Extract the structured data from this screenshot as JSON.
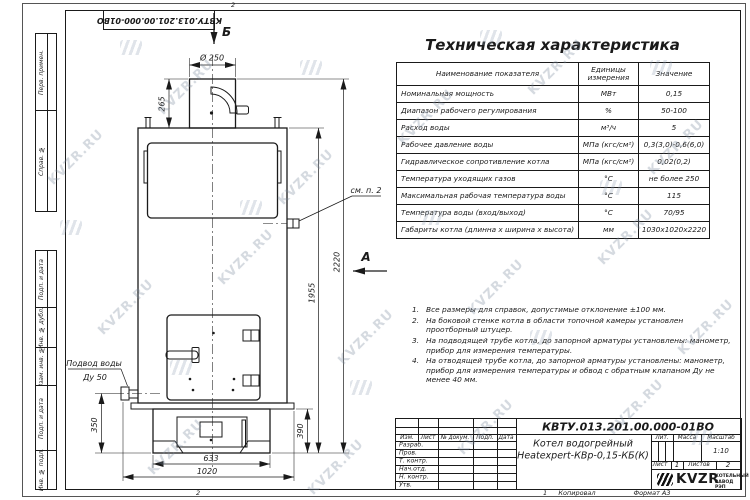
{
  "watermark": {
    "text": "KVZR.RU"
  },
  "margin": {
    "doc_number_rotated": "КВТУ.013.201.00.000-01ВО",
    "zone_top": "2",
    "zone_bottom_a": "2",
    "zone_bottom_b": "1",
    "copied_label": "Копировал",
    "format_label": "Формат А3",
    "side_boxes": [
      {
        "label": "Перв. примен."
      },
      {
        "label": "Справ. №"
      },
      {
        "label": "Подп. и дата"
      },
      {
        "label": "Инв. № дубл."
      },
      {
        "label": "Взам. инв. №"
      },
      {
        "label": "Подп. и дата"
      },
      {
        "label": "Инв. № подл."
      }
    ]
  },
  "spec_table": {
    "title": "Техническая характеристика",
    "headers": [
      "Наименование показателя",
      "Единицы измерения",
      "Значение"
    ],
    "rows": [
      {
        "name": "Номинальная мощность",
        "unit": "МВт",
        "value": "0,15"
      },
      {
        "name": "Диапазон рабочего регулирования",
        "unit": "%",
        "value": "50-100"
      },
      {
        "name": "Расход воды",
        "unit": "м³/ч",
        "value": "5"
      },
      {
        "name": "Рабочее давление воды",
        "unit": "МПа (кгс/см²)",
        "value": "0,3(3,0)-0,6(6,0)"
      },
      {
        "name": "Гидравлическое сопротивление котла",
        "unit": "МПа (кгс/см²)",
        "value": "0,02(0,2)"
      },
      {
        "name": "Температура уходящих газов",
        "unit": "°С",
        "value": "не более 250"
      },
      {
        "name": "Максимальная рабочая температура воды",
        "unit": "°С",
        "value": "115"
      },
      {
        "name": "Температура воды (вход/выход)",
        "unit": "°С",
        "value": "70/95"
      },
      {
        "name": "Габариты котла (длинна х ширина х высота)",
        "unit": "мм",
        "value": "1030х1020х2220"
      }
    ]
  },
  "notes": {
    "items": [
      {
        "num": "1.",
        "text": "Все размеры для справок, допустимые отклонение ±100 мм."
      },
      {
        "num": "2.",
        "text": "На боковой стенке котла в области топочной камеры установлен проотборный штуцер."
      },
      {
        "num": "3.",
        "text": "На подводящей трубе котла, до запорной арматуры установлены: манометр, прибор для измерения температуры."
      },
      {
        "num": "4.",
        "text": "На отводящей трубе котла, до запорной арматуры установлены: манометр, прибор для измерения температуры и обвод с обратным клапаном Ду не менее 40 мм."
      }
    ]
  },
  "drawing": {
    "labels": {
      "section_b": "Б",
      "section_a": "А",
      "dia_chimney": "Ø 250",
      "dim_chimney_h": "265",
      "dim_total_h": "2220",
      "dim_body_h": "1955",
      "dim_inlet_h": "350",
      "dim_base_h": "390",
      "dim_base_w": "633",
      "dim_total_w": "1020",
      "callout": "см. п. 2",
      "inlet_title": "Подвод воды",
      "inlet_size": "Ду 50"
    }
  },
  "title_block": {
    "doc_number": "КВТУ.013.201.00.000-01ВО",
    "name_line1": "Котел водогрейный",
    "name_line2": "Heatexpert-КВр-0,15-КБ(К)",
    "col_headers": [
      "Изм.",
      "Лист",
      "№ докум.",
      "Подп.",
      "Дата"
    ],
    "row_labels": [
      "Разраб.",
      "Пров.",
      "Т. контр.",
      "Нач.отд.",
      "Н. контр.",
      "Утв."
    ],
    "lit_label": "Лит.",
    "mass_label": "Масса",
    "scale_label": "Масштаб",
    "scale_value": "1:10",
    "sheet_label": "Лист",
    "sheet_value": "1",
    "sheets_label": "Листов",
    "sheets_value": "2",
    "logo_text": "KVZR",
    "logo_sub1": "КОТЕЛЬНЫЙ",
    "logo_sub2": "ЗАВОД РЭП"
  }
}
